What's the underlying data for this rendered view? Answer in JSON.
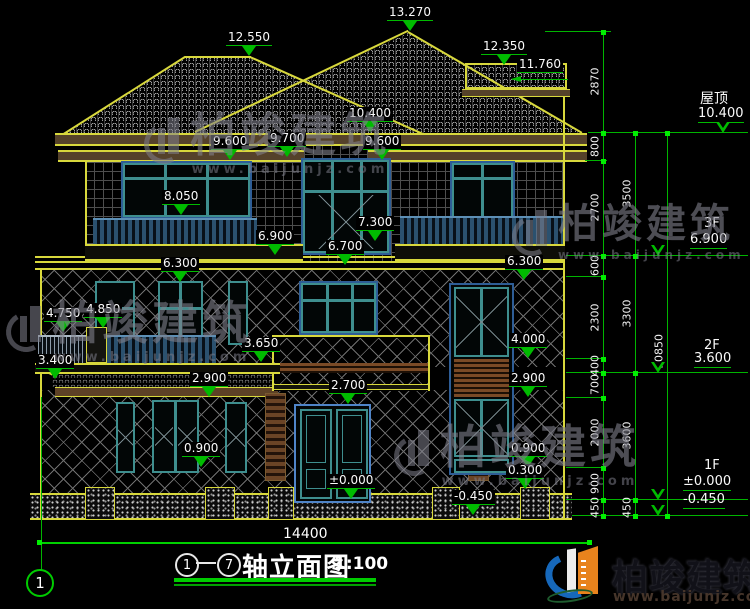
{
  "title": {
    "axis_from": "1",
    "axis_to": "7",
    "name": "轴立面图",
    "scale": "1:100"
  },
  "axis_bubble": "1",
  "levels": {
    "ridge_main": "13.270",
    "ridge_left": "12.550",
    "dormer_top": "12.350",
    "dormer_under": "11.760",
    "eave_main": "10.400",
    "eave_left": "9.600",
    "canopy_center": "9.700",
    "eave_right": "9.600",
    "sill_3f": "8.050",
    "balcony_3f": "6.900",
    "rail_3f_right": "7.300",
    "belt_center": "6.700",
    "belt_left": "6.300",
    "belt_right": "6.300",
    "rail_2f_left": "4.750",
    "rail_2f_mid": "4.850",
    "porch_floor": "3.650",
    "porch_eave": "3.400",
    "louver_top": "4.000",
    "porch_left": "2.900",
    "louver_bottom": "2.900",
    "door_top": "2.700",
    "sill_1f_left": "0.900",
    "sill_1f_right": "0.900",
    "base_right": "0.300",
    "ground_zero": "±0.000",
    "ground_neg": "-0.450"
  },
  "floors": {
    "roof_label": "屋顶",
    "roof_value": "10.400",
    "f3_label": "3F",
    "f3_value": "6.900",
    "f2_label": "2F",
    "f2_value": "3.600",
    "f1_label": "1F",
    "f1_value": "±0.000",
    "below_value": "-0.450"
  },
  "dims": {
    "chain_inner": [
      "2870",
      "800",
      "2700",
      "600",
      "2300",
      "400",
      "700",
      "2000",
      "900",
      "450"
    ],
    "chain_mid": [
      "3500",
      "3300",
      "3600",
      "450"
    ],
    "chain_outer": [
      "10850"
    ],
    "total_width": "14400"
  },
  "watermark": {
    "name": "柏竣建筑",
    "url": "www.baijunjz.com"
  },
  "brand": {
    "name": "柏竣建筑",
    "url": "www.baijunjz.com"
  }
}
